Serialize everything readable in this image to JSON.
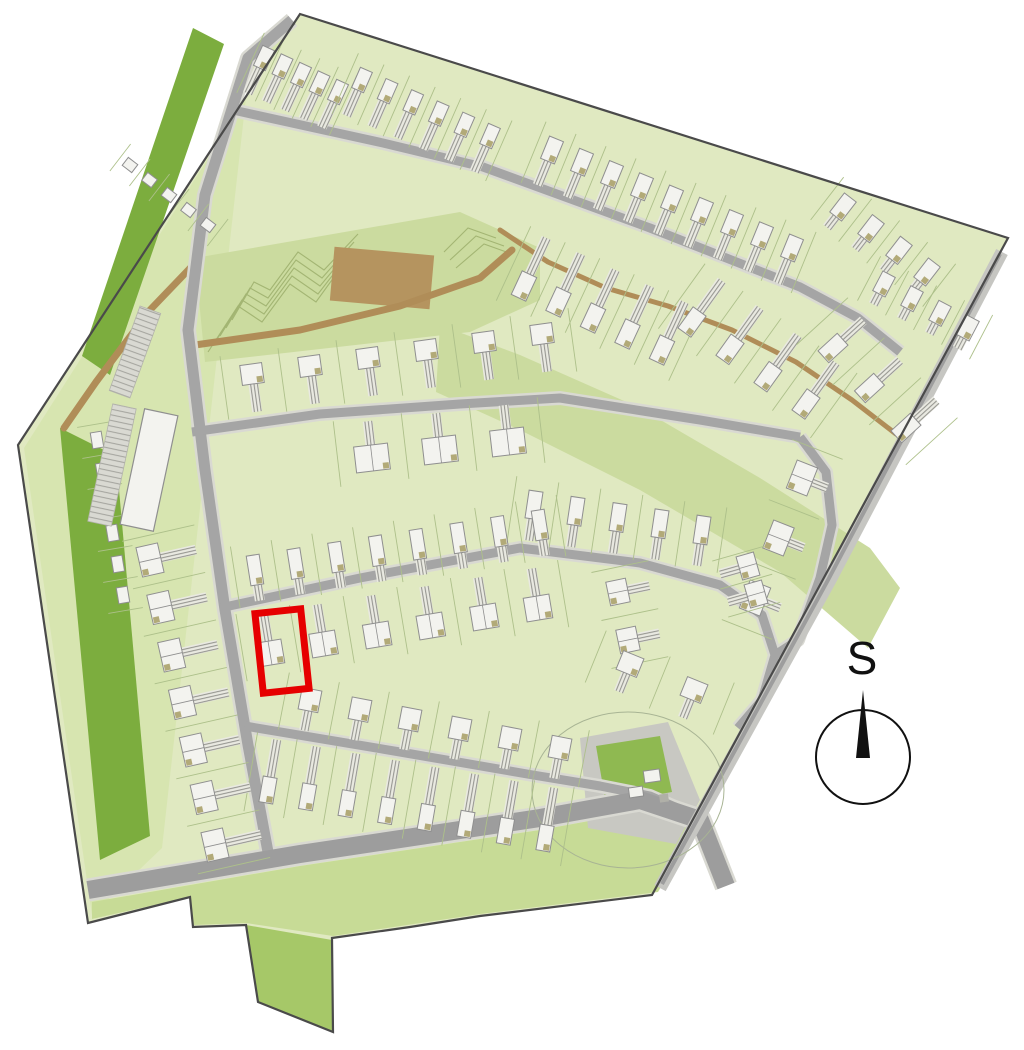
{
  "title": "Development site plan with highlighted plot",
  "compass": {
    "label": "S"
  },
  "colors": {
    "background": "#ffffff",
    "site_fill": "#e0e9c1",
    "open_green": "#cbdb9f",
    "verge_green": "#c7db96",
    "band_green": "#d7e5b0",
    "tail_green": "#a6c868",
    "dark_green": "#7cad3e",
    "road": "#a5a5a5",
    "road_casing": "#d9d9d2",
    "wide_road": "#9d9d9d",
    "se_strip": "#c6c6c2",
    "path_brown": "#b08d58",
    "patch_brown": "#b5945f",
    "contour": "#a3b573",
    "plot_line": "#adc08a",
    "house_fill": "#f3f3ef",
    "house_stroke": "#8f8f8f",
    "garage_accent": "#b2aa78",
    "apron_gray": "#c8c8c2",
    "utility_green": "#8fb951",
    "boundary": "#4a4a4a",
    "highlight_red": "#e60000",
    "compass_ink": "#111111"
  },
  "map": {
    "boundary": "M 300,14 L 1008,238 L 652,895 L 480,916 L 410,927 L 332,938 L 333,1032 L 258,1002 L 246,925 L 193,927 L 190,897 L 88,923 L 18,445 Z",
    "greens": [
      {
        "name": "nw-verge-band",
        "fill": "band_green",
        "pts": "24,448 296,20 250,62 162,848 92,915"
      },
      {
        "name": "playground-green",
        "fill": "open_green",
        "pts": "195,258 460,212 540,248 540,300 470,332 205,362"
      },
      {
        "name": "green-corridor",
        "fill": "open_green",
        "pts": "440,325 520,355 640,408 760,478 870,548 900,588 868,648 780,572 640,490 520,430 436,392"
      },
      {
        "name": "south-verge",
        "fill": "verge_green",
        "pts": "92,902 300,866 540,830 638,812 698,824 658,892 480,914 333,936 246,923 193,925 190,897 92,919"
      },
      {
        "name": "south-spur",
        "fill": "tail_green",
        "pts": "246,925 332,940 333,1032 258,1002"
      },
      {
        "name": "dark-strip-north",
        "fill": "dark_green",
        "pts": "193,28 224,44 110,375 82,356"
      },
      {
        "name": "dark-strip-west",
        "fill": "dark_green",
        "pts": "60,428 116,456 150,836 100,860"
      },
      {
        "name": "utility-apron",
        "fill": "apron_gray",
        "pts": "580,738 668,722 700,800 676,844 588,828"
      },
      {
        "name": "utility-green",
        "fill": "utility_green",
        "pts": "596,746 660,736 672,792 606,804"
      }
    ],
    "contours": [
      "208,352 238,306 262,322 290,284 316,302 342,266",
      "214,344 242,300 264,314 292,276 318,294 346,258",
      "220,336 246,294 266,306 294,268 320,286 350,250",
      "226,328 250,288 268,298 296,260 322,278 354,242",
      "232,320 254,282 270,290 298,252 324,270 358,234",
      "444,252 468,228 496,238",
      "450,260 476,236 504,246",
      "456,268 484,244 512,254"
    ],
    "brown_patch": {
      "cx": 382,
      "cy": 278,
      "w": 100,
      "h": 54,
      "rot": 5
    },
    "brown_paths": [
      {
        "pts": "64,428 96,382 150,310 196,262",
        "w": 7
      },
      {
        "pts": "188,346 300,330 400,306 480,278 512,250",
        "w": 7
      },
      {
        "pts": "500,230 548,262 606,288 668,306 732,330 796,362 852,400 896,434",
        "w": 5
      }
    ],
    "roads": [
      {
        "name": "spine-road",
        "pts": "292,20 248,58 205,195 188,330 205,470 225,610 248,745 268,852",
        "w": 11
      },
      {
        "name": "street-north",
        "pts": "233,110 383,143 483,167 650,228 800,287 858,318 900,352",
        "w": 9
      },
      {
        "name": "street-middle",
        "pts": "192,432 320,414 460,404 560,398 700,420 800,437",
        "w": 9
      },
      {
        "name": "east-connector",
        "pts": "800,437 826,472 832,525 820,578 798,640 775,655",
        "w": 9
      },
      {
        "name": "street-lower",
        "pts": "220,608 360,578 520,548 640,563 720,585 762,615 775,655 762,700 738,728",
        "w": 9
      },
      {
        "name": "street-south",
        "pts": "245,726 400,752 533,775 600,786 650,796 700,818",
        "w": 9
      },
      {
        "name": "boulevard-south",
        "pts": "88,890 300,854 540,818 640,800 700,820 726,886",
        "w": 18,
        "color": "wide_road"
      },
      {
        "name": "se-edge-strip",
        "pts": "1002,252 830,580 660,888",
        "w": 13,
        "color": "se_strip",
        "nocase": true
      },
      {
        "name": "se-edge-road",
        "pts": "1000,254 828,580 662,884",
        "w": 4,
        "color": "wide_road",
        "nocase": true
      }
    ],
    "attenuation_circle": {
      "cx": 628,
      "cy": 790,
      "rx": 96,
      "ry": 78
    },
    "utility_structures": {
      "white": [
        {
          "cx": 652,
          "cy": 776,
          "w": 16,
          "h": 12,
          "rot": -8
        },
        {
          "cx": 636,
          "cy": 792,
          "w": 14,
          "h": 10,
          "rot": -8
        }
      ],
      "gray": [
        {
          "cx": 664,
          "cy": 798,
          "w": 9,
          "h": 8,
          "rot": -8
        }
      ]
    },
    "buildings": [
      {
        "name": "apartment-block",
        "cx": 149,
        "cy": 470,
        "w": 34,
        "h": 118,
        "rot": 12
      }
    ],
    "parking_strips": [
      {
        "cx": 112,
        "cy": 465,
        "w": 24,
        "h": 120,
        "rot": 12
      },
      {
        "cx": 135,
        "cy": 352,
        "w": 22,
        "h": 90,
        "rot": 20
      }
    ],
    "house_rows": [
      {
        "x1": 264,
        "y1": 58,
        "x2": 338,
        "y2": 92,
        "n": 5,
        "w": 13,
        "h": 22,
        "d": 1,
        "dl": 28
      },
      {
        "x1": 362,
        "y1": 80,
        "x2": 490,
        "y2": 136,
        "n": 6,
        "w": 13,
        "h": 22,
        "d": 1,
        "dl": 28
      },
      {
        "x1": 552,
        "y1": 150,
        "x2": 792,
        "y2": 248,
        "n": 9,
        "w": 15,
        "h": 24,
        "d": 1,
        "dl": 26
      },
      {
        "x1": 843,
        "y1": 207,
        "x2": 927,
        "y2": 272,
        "n": 4,
        "w": 15,
        "h": 24,
        "d": 1,
        "dl": 14
      },
      {
        "x1": 884,
        "y1": 284,
        "x2": 968,
        "y2": 328,
        "n": 4,
        "w": 14,
        "h": 22,
        "d": 1,
        "dl": 12
      },
      {
        "x1": 524,
        "y1": 286,
        "x2": 662,
        "y2": 350,
        "n": 5,
        "w": 16,
        "h": 26,
        "d": -1,
        "dl": 40
      },
      {
        "x1": 692,
        "y1": 322,
        "x2": 806,
        "y2": 404,
        "n": 4,
        "w": 16,
        "h": 26,
        "d": -1,
        "dl": 38
      },
      {
        "x1": 833,
        "y1": 348,
        "x2": 906,
        "y2": 428,
        "n": 3,
        "w": 16,
        "h": 26,
        "d": -1,
        "dl": 28
      },
      {
        "x1": 252,
        "y1": 374,
        "x2": 542,
        "y2": 334,
        "n": 6,
        "w": 22,
        "h": 20,
        "d": 1,
        "dl": 28
      },
      {
        "x1": 372,
        "y1": 458,
        "x2": 508,
        "y2": 442,
        "n": 3,
        "w": 34,
        "h": 26,
        "d": -1,
        "dl": 24
      },
      {
        "x1": 802,
        "y1": 478,
        "x2": 755,
        "y2": 598,
        "n": 3,
        "w": 30,
        "h": 22,
        "d": -1,
        "dl": 16
      },
      {
        "x1": 534,
        "y1": 505,
        "x2": 702,
        "y2": 530,
        "n": 5,
        "w": 14,
        "h": 28,
        "d": 1,
        "dl": 22
      },
      {
        "x1": 255,
        "y1": 570,
        "x2": 540,
        "y2": 525,
        "n": 8,
        "w": 13,
        "h": 30,
        "d": 1,
        "dl": 16
      },
      {
        "x1": 270,
        "y1": 653,
        "x2": 538,
        "y2": 608,
        "n": 6,
        "w": 26,
        "h": 24,
        "d": -1,
        "dl": 28
      },
      {
        "x1": 618,
        "y1": 592,
        "x2": 628,
        "y2": 640,
        "n": 2,
        "w": 24,
        "h": 20,
        "d": -1,
        "dl": 22
      },
      {
        "x1": 748,
        "y1": 566,
        "x2": 756,
        "y2": 594,
        "n": 2,
        "w": 24,
        "h": 18,
        "d": 1,
        "dl": 20
      },
      {
        "x1": 630,
        "y1": 664,
        "x2": 694,
        "y2": 690,
        "n": 2,
        "w": 22,
        "h": 20,
        "d": 1,
        "dl": 20
      },
      {
        "x1": 310,
        "y1": 700,
        "x2": 560,
        "y2": 748,
        "n": 6,
        "w": 20,
        "h": 22,
        "d": 1,
        "dl": 20
      },
      {
        "x1": 268,
        "y1": 790,
        "x2": 545,
        "y2": 838,
        "n": 8,
        "w": 14,
        "h": 26,
        "d": -1,
        "dl": 38
      },
      {
        "x1": 150,
        "y1": 560,
        "x2": 215,
        "y2": 845,
        "n": 7,
        "w": 30,
        "h": 22,
        "d": -1,
        "dl": 36
      },
      {
        "x1": 97,
        "y1": 440,
        "x2": 123,
        "y2": 595,
        "n": 6,
        "w": 16,
        "h": 11,
        "d": 0
      },
      {
        "x1": 130,
        "y1": 165,
        "x2": 208,
        "y2": 225,
        "n": 5,
        "w": 12,
        "h": 10,
        "d": 0
      }
    ],
    "highlight": {
      "cx": 282,
      "cy": 651,
      "w": 46,
      "h": 80,
      "rot": -6,
      "stroke": 7
    },
    "compass_geo": {
      "cx": 863,
      "cy": 757,
      "r": 47,
      "needle": "M863,690 L856,758 L870,758 Z",
      "label_x": 862,
      "label_y": 674,
      "font": 46
    }
  }
}
